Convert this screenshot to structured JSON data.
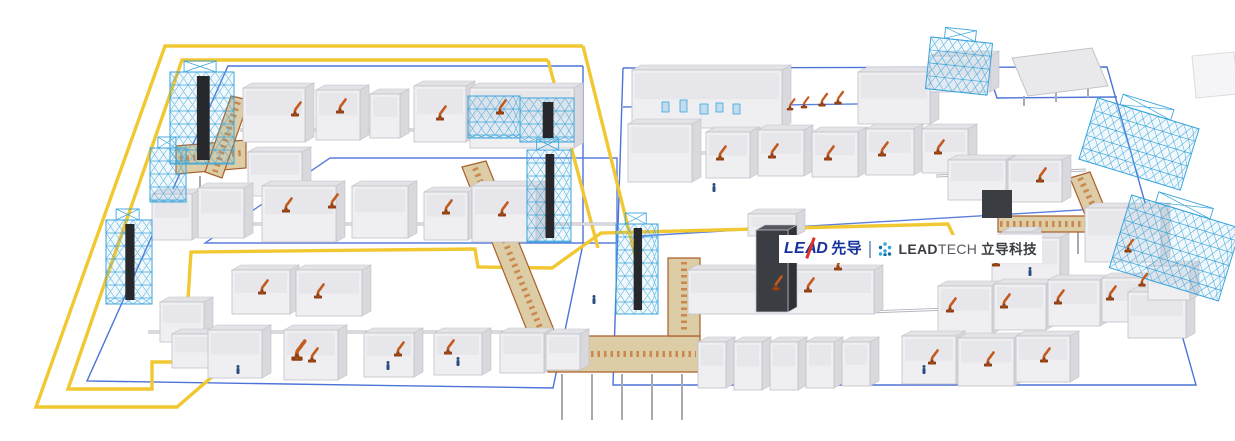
{
  "meta": {
    "title": "LEAD intelligent production line layout",
    "background": "#ffffff"
  },
  "logo": {
    "lead_le": "LE",
    "lead_a": "A",
    "lead_d": "D",
    "lead_cn": "先导",
    "tech_bold": "LEAD",
    "tech_light": "TECH",
    "tech_cn": "立导科技",
    "colors": {
      "navy": "#16339B",
      "red": "#E23128",
      "dark": "#3A3D42",
      "light_dark": "#55585E",
      "divider": "#8FA3CC",
      "dot_main": "#2EA7DC",
      "dot_deep": "#156E9E"
    }
  },
  "palette": {
    "agv": "#F2C832",
    "zone": "#4C73D8",
    "zone2": "#5C7FDE",
    "rack": "#39A5DC",
    "rackFill": "rgba(120,190,230,0.10)",
    "dark": "#26282C",
    "darkEquip": "#3A3D42",
    "machFront": "#EFEFF2",
    "machTop": "#E3E3E7",
    "machSide": "#D8D8DD",
    "machStroke": "#C0C0C8",
    "machInner": "#E7E7EB",
    "darkFront": "#3A3D42",
    "darkTop": "#54575D",
    "darkSide": "#2E3135",
    "convTan": "#DCCDA6",
    "convOrange": "#C77C3F",
    "convRail": "#A95F2B",
    "railDark": "#B5B5BE",
    "railLight": "#FFFFFF",
    "leg": "#A9A9B2",
    "robot": "#C35A1E",
    "robotDark": "#8F3F12",
    "person": "#2B4A7E",
    "panelFill": "#E9E9EC",
    "panelStroke": "#C2C2C8",
    "panelFaintFill": "#F5F5F7",
    "panelFaintStroke": "#DCDCE0"
  },
  "scene": {
    "zones": [
      {
        "pts": [
          [
            583,
            66
          ],
          [
            228,
            66
          ],
          [
            87,
            381
          ],
          [
            553,
            388
          ],
          [
            583,
            244
          ],
          [
            583,
            66
          ]
        ],
        "c": "#4C73D8"
      },
      {
        "pts": [
          [
            330,
            158
          ],
          [
            617,
            158
          ],
          [
            617,
            243
          ],
          [
            205,
            243
          ],
          [
            330,
            158
          ]
        ],
        "c": "#5C7FDE"
      },
      {
        "pts": [
          [
            623,
            68
          ],
          [
            1107,
            67
          ],
          [
            1196,
            385
          ],
          [
            613,
            385
          ],
          [
            623,
            68
          ]
        ],
        "c": "#4C73D8"
      },
      {
        "pts": [
          [
            623,
            107
          ],
          [
            934,
            103
          ]
        ],
        "c": "#5C7FDE"
      },
      {
        "pts": [
          [
            640,
            236
          ],
          [
            1148,
            206
          ]
        ],
        "c": "#5C7FDE"
      },
      {
        "pts": [
          [
            987,
            68
          ],
          [
            997,
            98
          ],
          [
            1117,
            97
          ]
        ],
        "c": "#4C73D8"
      }
    ],
    "agv_paths": [
      [
        [
          583,
          46
        ],
        [
          165,
          46
        ],
        [
          36,
          407
        ],
        [
          177,
          407
        ],
        [
          242,
          351
        ]
      ],
      [
        [
          583,
          46
        ],
        [
          634,
          251
        ],
        [
          637,
          267
        ]
      ],
      [
        [
          548,
          60
        ],
        [
          182,
          60
        ],
        [
          68,
          389
        ],
        [
          152,
          389
        ],
        [
          152,
          362
        ],
        [
          184,
          362
        ],
        [
          191,
          252
        ],
        [
          475,
          249
        ],
        [
          478,
          267
        ],
        [
          552,
          268
        ],
        [
          601,
          233
        ],
        [
          948,
          224
        ],
        [
          956,
          241
        ]
      ],
      [
        [
          548,
          60
        ],
        [
          598,
          248
        ]
      ]
    ],
    "rails": [
      [
        [
          240,
          130
        ],
        [
          578,
          130
        ]
      ],
      [
        [
          150,
          224
        ],
        [
          616,
          224
        ]
      ],
      [
        [
          148,
          332
        ],
        [
          566,
          332
        ]
      ],
      [
        [
          628,
          154
        ],
        [
          940,
          150
        ]
      ],
      [
        [
          936,
          176
        ],
        [
          1086,
          170
        ]
      ],
      [
        [
          868,
          312
        ],
        [
          1140,
          302
        ]
      ]
    ],
    "conveyors": [
      {
        "pts": [
          [
            176,
            146
          ],
          [
            246,
            140
          ],
          [
            246,
            168
          ],
          [
            176,
            174
          ]
        ],
        "axis": [
          [
            180,
            159
          ],
          [
            242,
            153
          ]
        ]
      },
      {
        "pts": [
          [
            231,
            96
          ],
          [
            249,
            100
          ],
          [
            222,
            178
          ],
          [
            205,
            172
          ]
        ],
        "axis": [
          [
            238,
            102
          ],
          [
            215,
            172
          ]
        ]
      },
      {
        "pts": [
          [
            462,
            167
          ],
          [
            486,
            161
          ],
          [
            554,
            330
          ],
          [
            530,
            338
          ]
        ],
        "axis": [
          [
            475,
            168
          ],
          [
            541,
            330
          ]
        ]
      },
      {
        "pts": [
          [
            548,
            336
          ],
          [
            700,
            336
          ],
          [
            700,
            372
          ],
          [
            548,
            372
          ]
        ],
        "axis": [
          [
            552,
            354
          ],
          [
            696,
            354
          ]
        ]
      },
      {
        "pts": [
          [
            668,
            258
          ],
          [
            700,
            258
          ],
          [
            700,
            336
          ],
          [
            668,
            336
          ]
        ],
        "axis": [
          [
            684,
            262
          ],
          [
            684,
            332
          ]
        ]
      },
      {
        "pts": [
          [
            998,
            216
          ],
          [
            1104,
            216
          ],
          [
            1104,
            232
          ],
          [
            998,
            232
          ]
        ],
        "axis": [
          [
            1000,
            224
          ],
          [
            1102,
            224
          ]
        ]
      },
      {
        "pts": [
          [
            1070,
            178
          ],
          [
            1090,
            172
          ],
          [
            1108,
            216
          ],
          [
            1088,
            222
          ]
        ],
        "axis": [
          [
            1080,
            178
          ],
          [
            1098,
            216
          ]
        ]
      }
    ],
    "legs": [
      [
        562,
        374,
        562,
        420
      ],
      [
        592,
        374,
        592,
        420
      ],
      [
        622,
        374,
        622,
        420
      ],
      [
        652,
        374,
        652,
        420
      ],
      [
        682,
        374,
        682,
        420
      ],
      [
        1010,
        232,
        1010,
        252
      ],
      [
        1044,
        232,
        1044,
        252
      ],
      [
        1078,
        232,
        1078,
        254
      ],
      [
        250,
        168,
        250,
        182
      ],
      [
        200,
        176,
        200,
        190
      ],
      [
        1024,
        96,
        1024,
        106
      ],
      [
        1056,
        92,
        1056,
        102
      ],
      [
        1088,
        88,
        1088,
        98
      ]
    ],
    "machines": [
      [
        243,
        142,
        62,
        54
      ],
      [
        316,
        140,
        44,
        50
      ],
      [
        370,
        138,
        30,
        44
      ],
      [
        414,
        142,
        52,
        56
      ],
      [
        470,
        148,
        104,
        60
      ],
      [
        248,
        196,
        54,
        44
      ],
      [
        152,
        240,
        40,
        46
      ],
      [
        198,
        238,
        46,
        50
      ],
      [
        262,
        242,
        74,
        56
      ],
      [
        352,
        238,
        56,
        52
      ],
      [
        424,
        240,
        44,
        48
      ],
      [
        472,
        242,
        64,
        56
      ],
      [
        232,
        314,
        58,
        44
      ],
      [
        296,
        316,
        66,
        46
      ],
      [
        160,
        342,
        44,
        40
      ],
      [
        172,
        368,
        44,
        34
      ],
      [
        208,
        378,
        54,
        48
      ],
      [
        284,
        380,
        54,
        50
      ],
      [
        364,
        377,
        50,
        44
      ],
      [
        434,
        375,
        48,
        42
      ],
      [
        500,
        373,
        44,
        40
      ],
      [
        546,
        370,
        34,
        36
      ],
      [
        632,
        128,
        150,
        58
      ],
      [
        858,
        124,
        72,
        52
      ],
      [
        930,
        92,
        60,
        36
      ],
      [
        628,
        182,
        64,
        58
      ],
      [
        706,
        178,
        44,
        46
      ],
      [
        758,
        176,
        46,
        46
      ],
      [
        812,
        177,
        46,
        45
      ],
      [
        866,
        175,
        48,
        46
      ],
      [
        922,
        173,
        46,
        44
      ],
      [
        948,
        200,
        58,
        40
      ],
      [
        1008,
        202,
        54,
        42
      ],
      [
        1002,
        282,
        30,
        50
      ],
      [
        992,
        290,
        68,
        52
      ],
      [
        1085,
        262,
        76,
        54
      ],
      [
        748,
        236,
        48,
        22
      ],
      [
        688,
        314,
        186,
        44
      ],
      [
        698,
        388,
        28,
        46
      ],
      [
        734,
        390,
        28,
        48
      ],
      [
        770,
        390,
        28,
        48
      ],
      [
        806,
        388,
        28,
        46
      ],
      [
        842,
        386,
        28,
        44
      ],
      [
        938,
        334,
        54,
        48
      ],
      [
        994,
        330,
        52,
        46
      ],
      [
        1048,
        326,
        52,
        46
      ],
      [
        1102,
        322,
        50,
        44
      ],
      [
        902,
        384,
        54,
        48
      ],
      [
        958,
        386,
        56,
        48
      ],
      [
        1016,
        382,
        54,
        46
      ],
      [
        1128,
        338,
        58,
        46
      ],
      [
        1148,
        300,
        42,
        34
      ],
      [
        756,
        312,
        32,
        82,
        "dark"
      ]
    ],
    "darks": [
      [
        982,
        190,
        30,
        28
      ]
    ],
    "accents": [
      [
        662,
        102,
        7,
        10
      ],
      [
        680,
        100,
        7,
        12
      ],
      [
        700,
        104,
        8,
        10
      ],
      [
        716,
        103,
        7,
        9
      ],
      [
        733,
        104,
        7,
        10
      ]
    ],
    "racks": [
      [
        170,
        72,
        64,
        92,
        0,
        1
      ],
      [
        106,
        220,
        46,
        84,
        0,
        1
      ],
      [
        150,
        148,
        36,
        54,
        0,
        0
      ],
      [
        527,
        150,
        44,
        92,
        0,
        1
      ],
      [
        616,
        224,
        42,
        90,
        0,
        1
      ],
      [
        468,
        96,
        52,
        42,
        0,
        0
      ],
      [
        520,
        98,
        54,
        44,
        0,
        1
      ],
      [
        928,
        40,
        62,
        52,
        6,
        0
      ],
      [
        1086,
        112,
        106,
        64,
        17,
        0
      ],
      [
        1118,
        210,
        114,
        76,
        17,
        0
      ]
    ],
    "panels": [
      {
        "pts": [
          [
            1012,
            58
          ],
          [
            1092,
            48
          ],
          [
            1108,
            86
          ],
          [
            1028,
            96
          ]
        ],
        "faint": false
      },
      {
        "pts": [
          [
            1192,
            56
          ],
          [
            1234,
            52
          ],
          [
            1238,
            94
          ],
          [
            1196,
            98
          ]
        ],
        "faint": true
      }
    ],
    "robots": [
      [
        295,
        116,
        1
      ],
      [
        340,
        113,
        1
      ],
      [
        440,
        120,
        1
      ],
      [
        500,
        114,
        1
      ],
      [
        286,
        212,
        1
      ],
      [
        332,
        208,
        1
      ],
      [
        446,
        214,
        1
      ],
      [
        502,
        216,
        1
      ],
      [
        262,
        294,
        1
      ],
      [
        318,
        298,
        1
      ],
      [
        297,
        360,
        1.4
      ],
      [
        312,
        362,
        1
      ],
      [
        398,
        356,
        1
      ],
      [
        448,
        354,
        1
      ],
      [
        790,
        110,
        0.8
      ],
      [
        804,
        108,
        0.8
      ],
      [
        822,
        106,
        0.9
      ],
      [
        838,
        104,
        0.9
      ],
      [
        720,
        160,
        1
      ],
      [
        772,
        158,
        1
      ],
      [
        828,
        160,
        1
      ],
      [
        882,
        156,
        1
      ],
      [
        938,
        154,
        1
      ],
      [
        1040,
        182,
        1
      ],
      [
        996,
        266,
        1
      ],
      [
        776,
        290,
        1
      ],
      [
        808,
        292,
        1
      ],
      [
        838,
        270,
        1
      ],
      [
        950,
        312,
        1
      ],
      [
        1004,
        308,
        1
      ],
      [
        1058,
        304,
        1
      ],
      [
        1110,
        300,
        1
      ],
      [
        932,
        364,
        1
      ],
      [
        988,
        366,
        1
      ],
      [
        1044,
        362,
        1
      ],
      [
        1128,
        252,
        0.9
      ],
      [
        1142,
        286,
        0.9
      ]
    ],
    "people": [
      [
        238,
        374
      ],
      [
        388,
        370
      ],
      [
        458,
        366
      ],
      [
        714,
        192
      ],
      [
        924,
        374
      ],
      [
        1030,
        276
      ],
      [
        594,
        304
      ]
    ]
  }
}
